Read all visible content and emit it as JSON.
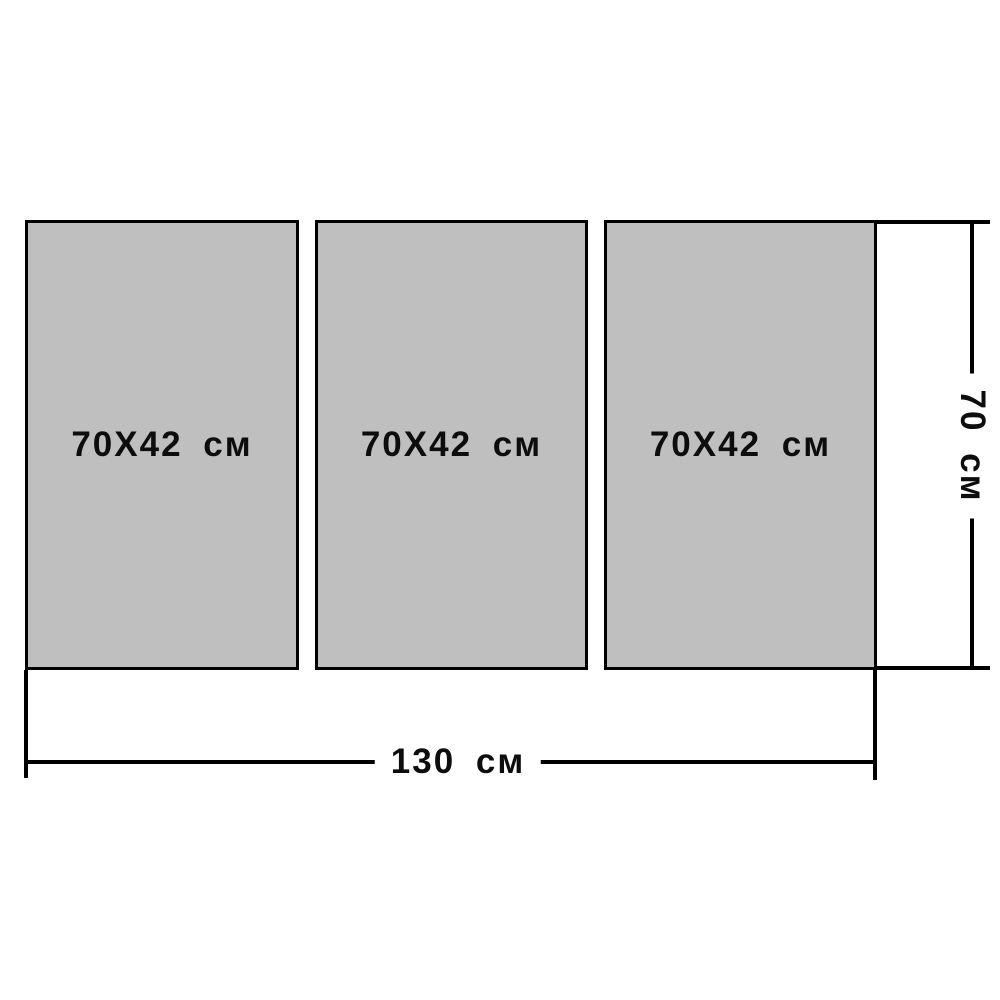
{
  "diagram": {
    "description": "modular-triptych-size-diagram",
    "panels": [
      {
        "label": "70X42 см"
      },
      {
        "label": "70X42 см"
      },
      {
        "label": "70X42 см"
      }
    ],
    "dimensions": {
      "width": {
        "label": "130 см"
      },
      "height": {
        "label": "70 см"
      }
    },
    "colors": {
      "background": "#ffffff",
      "panel_fill": "#bfbfbf",
      "line": "#000000",
      "text": "#0d0d0d"
    }
  }
}
